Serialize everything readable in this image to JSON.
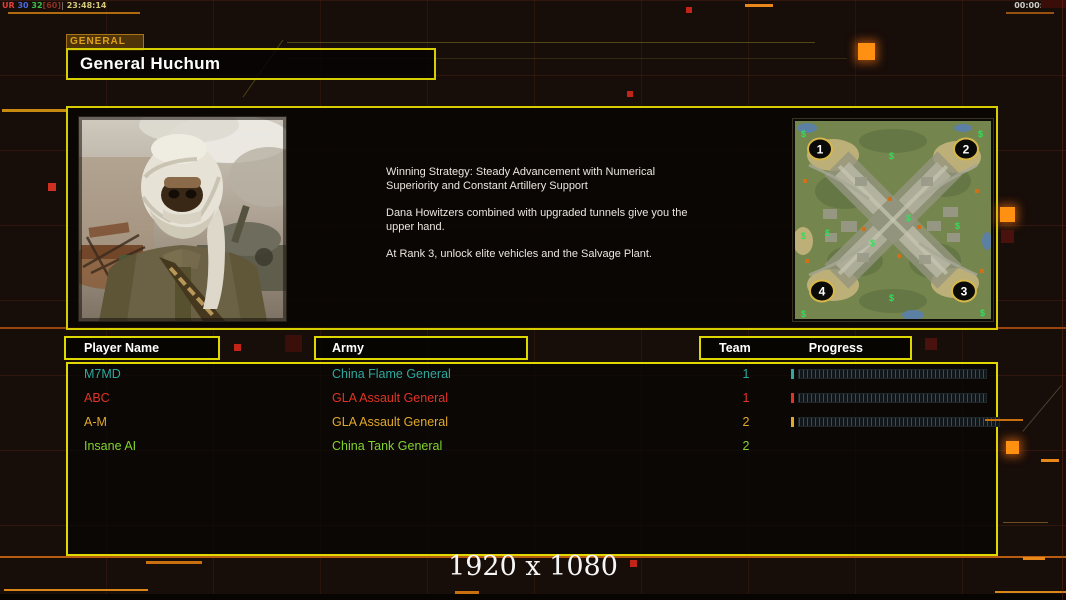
{
  "topbar": {
    "gentool": {
      "ur": "UR",
      "v1": "30",
      "v2": "32",
      "v3": "[60]",
      "sep": "|",
      "time": "23:48:14"
    },
    "timer": "00:00:00"
  },
  "general_panel": {
    "tab_label": "GENERAL",
    "general_name": "General Huchum",
    "strategy_lines": [
      "Winning Strategy: Steady Advancement with Numerical Superiority and Constant Artillery Support",
      "Dana Howitzers combined with upgraded tunnels give you the upper hand.",
      "At Rank 3, unlock elite vehicles and the Salvage Plant."
    ]
  },
  "minimap": {
    "spawn_labels": [
      "1",
      "2",
      "3",
      "4"
    ],
    "money_icon": "$"
  },
  "lobby_table": {
    "headers": {
      "player_name": "Player Name",
      "army": "Army",
      "team": "Team",
      "progress": "Progress"
    },
    "rows": [
      {
        "player_name": "M7MD",
        "army": "China Flame General",
        "team": "1",
        "color": "#2fa89e",
        "progress_visible": true
      },
      {
        "player_name": "ABC",
        "army": "GLA Assault General",
        "team": "1",
        "color": "#e23325",
        "progress_visible": true
      },
      {
        "player_name": "A-M",
        "army": "GLA Assault General",
        "team": "2",
        "color": "#e2a82a",
        "progress_visible": true
      },
      {
        "player_name": "Insane AI",
        "army": "China Tank General",
        "team": "2",
        "color": "#84d22e",
        "progress_visible": false
      }
    ]
  },
  "footer": {
    "resolution_label": "1920 x 1080"
  },
  "colors": {
    "frame_yellow": "#d6ce00",
    "accent_orange": "#e07818",
    "bright_orange": "#ff9012",
    "alert_red": "#c22418"
  }
}
